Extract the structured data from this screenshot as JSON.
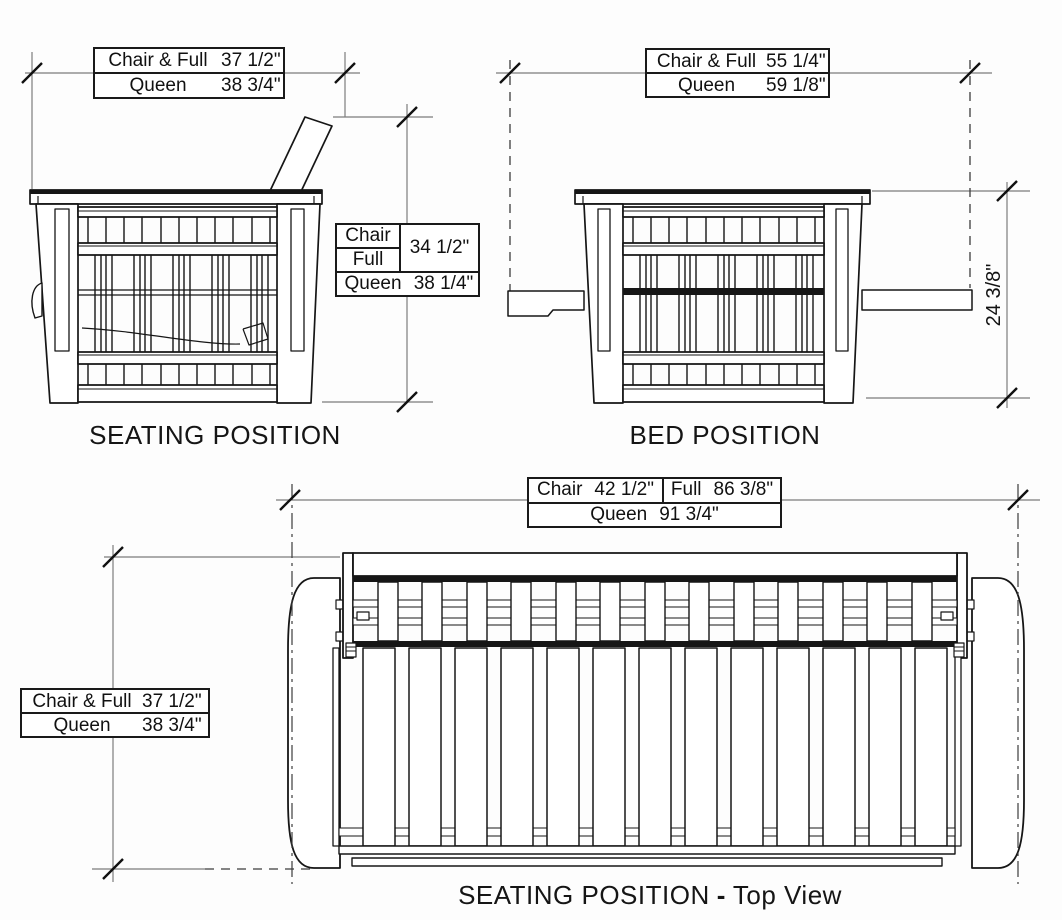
{
  "views": {
    "seating": {
      "caption": "SEATING POSITION"
    },
    "bed": {
      "caption": "BED POSITION"
    },
    "top": {
      "caption_main": "SEATING POSITION",
      "caption_dash": "-",
      "caption_suffix": "Top View"
    }
  },
  "dimensions": {
    "seating_width": {
      "row1_label": "Chair & Full",
      "row1_value": "37 1/2\"",
      "row2_label": "Queen",
      "row2_value": "38 3/4\""
    },
    "seating_height": {
      "row1_label": "Chair",
      "row2_label": "Full",
      "merged_value": "34 1/2\"",
      "row3_label": "Queen",
      "row3_value": "38 1/4\""
    },
    "bed_width": {
      "row1_label": "Chair & Full",
      "row1_value": "55 1/4\"",
      "row2_label": "Queen",
      "row2_value": "59 1/8\""
    },
    "bed_height": {
      "value": "24 3/8\""
    },
    "top_width": {
      "cell_chair_label": "Chair",
      "cell_chair_value": "42 1/2\"",
      "cell_full_label": "Full",
      "cell_full_value": "86 3/8\"",
      "row2_label": "Queen",
      "row2_value": "91 3/4\""
    },
    "top_depth": {
      "row1_label": "Chair & Full",
      "row1_value": "37 1/2\"",
      "row2_label": "Queen",
      "row2_value": "38 3/4\""
    }
  }
}
